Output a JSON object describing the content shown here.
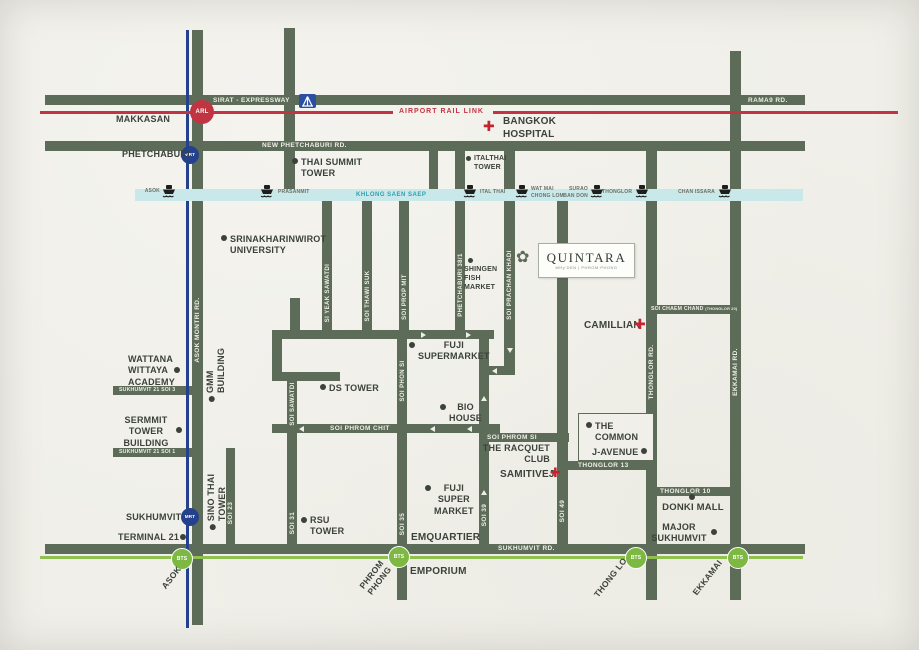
{
  "brand": {
    "name": "QUINTARA",
    "tagline": "MHy’DEN  |  PHROM PHONG"
  },
  "icons": {
    "bullet": "●",
    "flower": "✿",
    "cross": "✚"
  },
  "colors": {
    "road_green": "#5d6b59",
    "label_dark": "#3a423a",
    "arl_red": "#c13543",
    "mrt_navy": "#24418e",
    "bts_green": "#7db842",
    "canal_blue": "#c9e8ea",
    "paper": "#f0efe9"
  },
  "roads": {
    "sirat": "SIRAT - EXPRESSWAY",
    "rama9": "RAMA9 RD.",
    "new_phetchaburi": "NEW PHETCHABURI RD.",
    "sukhumvit": "SUKHUMVIT RD.",
    "suk21_soi3": "SUKHUMVIT 21 SOI 3",
    "suk21_soi1": "SUKHUMVIT 21 SOI 1",
    "phrom_chit": "SOI PHROM CHIT",
    "phrom_si": "SOI PHROM SI",
    "thonglor13": "THONGLOR 13",
    "thonglor10": "THONGLOR 10",
    "chaem_chand": "SOI CHAEM CHAND",
    "chaem_chand_sub": "(THONGLOR 20)",
    "asok_montri": "ASOK MONTRI RD.",
    "si_yeak_sawatdi": "SI YEAK SAWATDI",
    "thawi_suk": "SOI THAWI SUK",
    "prop_mit": "SOI PROP MIT",
    "phon_si": "SOI PHON SI",
    "sawatdi": "SOI SAWATDI",
    "soi31": "SOI 31",
    "soi35": "SOI 35",
    "soi39": "SOI 39",
    "soi23": "SOI 23",
    "soi49": "SOI 49",
    "prachan_khadi": "SOI PRACHAN KHADI",
    "phetchaburi381": "PHETCHABURI 38/1",
    "thonglor_rd": "THONGLOR RD.",
    "ekkamai_rd": "EKKAMAI RD."
  },
  "transit": {
    "arl": {
      "badge": "ARL",
      "line_label": "AIRPORT RAIL LINK",
      "station": "MAKKASAN"
    },
    "mrt": {
      "badge": "MRT",
      "phetchaburi": "PHETCHABURI",
      "sukhumvit": "SUKHUMVIT"
    },
    "bts": {
      "badge": "BTS",
      "asok": "ASOK",
      "phrom_phong": "PHROM\nPHONG",
      "thong_lo": "THONG LO",
      "ekkamai": "EKKAMAI"
    },
    "canal": {
      "name": "KHLONG SAEN SAEP",
      "piers": [
        {
          "name": "ASOK"
        },
        {
          "name": "PRASANMIT"
        },
        {
          "name": "ITAL THAI"
        },
        {
          "name": "WAT MAI\nCHONG LOM"
        },
        {
          "name": "SURAO\nBAN DON"
        },
        {
          "name": "THONGLOR"
        },
        {
          "name": "CHAN ISSARA"
        }
      ]
    }
  },
  "places": {
    "bangkok_hospital": "BANGKOK\nHOSPITAL",
    "thai_summit": "THAI SUMMIT\nTOWER",
    "italthai": "ITALTHAI\nTOWER",
    "srinakharinwirot": "SRINAKHARINWIROT\nUNIVERSITY",
    "shingen": "SHINGEN\nFISH\nMARKET",
    "fuji_supermarket": "FUJI\nSUPERMARKET",
    "bio_house": "BIO\nHOUSE",
    "ds_tower": "DS TOWER",
    "camillian": "CAMILLIAN",
    "the_common": "THE\nCOMMON",
    "j_avenue": "J-AVENUE",
    "racquet_club": "THE RACQUET\nCLUB",
    "samitivej": "SAMITIVEJ",
    "donki_mall": "DONKI MALL",
    "major_sukhumvit": "MAJOR\nSUKHUMVIT",
    "wattana": "WATTANA\nWITTAYA\nACADEMY",
    "gmm": "GMM\nBUILDING",
    "sermmit": "SERMMIT\nTOWER\nBUILDING",
    "sino_thai": "SINO THAI\nTOWER",
    "terminal21": "TERMINAL 21",
    "rsu": "RSU\nTOWER",
    "fuji_super_market": "FUJI\nSUPER\nMARKET",
    "emquartier": "EMQUARTIER",
    "emporium": "EMPORIUM"
  }
}
